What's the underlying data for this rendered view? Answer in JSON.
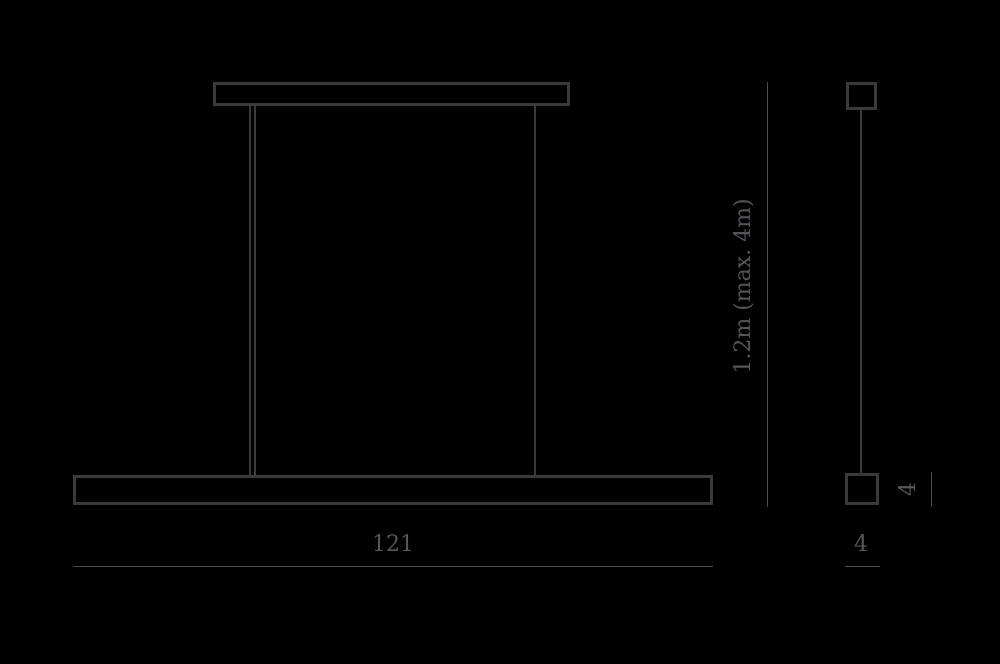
{
  "diagram": {
    "kind": "technical-dimension-drawing",
    "subject": "linear-suspension-pendant-lamp",
    "views": [
      "front",
      "side"
    ]
  },
  "dimensions": {
    "length": {
      "label": "121"
    },
    "height": {
      "label": "1.2m (max. 4m)"
    },
    "depth": {
      "label": "4"
    },
    "bar_height": {
      "label": "4"
    }
  },
  "colors": {
    "background": "#000000",
    "outline": "#3a3a3c",
    "dimension_line": "#4e4e52",
    "text": "#55555a"
  }
}
